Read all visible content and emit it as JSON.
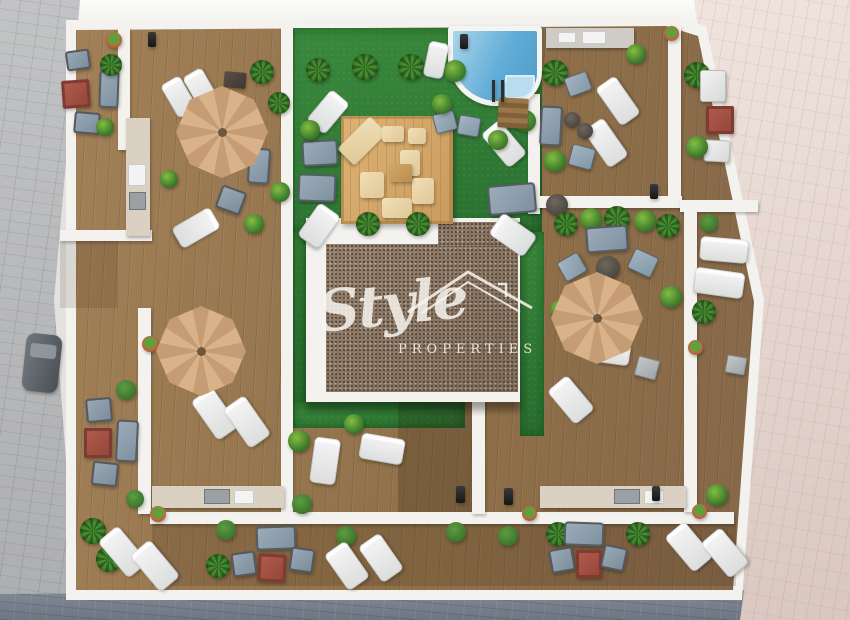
{
  "meta": {
    "image_type": "3d-aerial-architectural-render",
    "subject": "rooftop terrace site plan of apartment building with pool, garden courtyard, wooden deck terraces and outdoor furniture"
  },
  "watermark": {
    "brand_script": "Style",
    "brand_caps": "PROPERTIES",
    "logo_icon": "house-roof-outline"
  },
  "colors": {
    "wall": "#f3f2ee",
    "gravel-dot": "#55463a",
    "watermark": "rgba(248,245,238,0.85)",
    "lawn": "#2f7c33",
    "wood": "#9a7a52",
    "pool-water": "#5fa9d4",
    "umbrella": "#d3a87f",
    "pave-grey": "#b4b5b7",
    "pave-blue": "#79818c",
    "pave-pink": "#e0d2cb",
    "accent-red": "#a85043"
  },
  "areas": {
    "streets": [
      "left-grey-pavement",
      "bottom-blue-grey-pavement",
      "right-pink-pavement"
    ],
    "terraces": [
      "top-left-terrace",
      "left-terrace",
      "top-right-terrace",
      "right-terrace",
      "mid-right-terrace",
      "bottom-terrace"
    ],
    "courtyard": [
      "lawn",
      "swimming-pool",
      "sun-deck-platform",
      "central-building-white-roof",
      "central-building-gravel-roof"
    ]
  },
  "objects": [
    {
      "t": "umbrella",
      "x": 176,
      "y": 86,
      "w": 92,
      "h": 92,
      "r": 0
    },
    {
      "t": "umbrella",
      "x": 156,
      "y": 306,
      "w": 90,
      "h": 90,
      "r": 0
    },
    {
      "t": "umbrella",
      "x": 551,
      "y": 272,
      "w": 92,
      "h": 92,
      "r": 0
    },
    {
      "t": "car",
      "x": 24,
      "y": 334,
      "w": 36,
      "h": 58,
      "r": 6
    },
    {
      "t": "bollard",
      "x": 148,
      "y": 32,
      "w": 8,
      "h": 15,
      "r": 0
    },
    {
      "t": "bollard",
      "x": 460,
      "y": 34,
      "w": 8,
      "h": 15,
      "r": 0
    },
    {
      "t": "bollard",
      "x": 650,
      "y": 184,
      "w": 8,
      "h": 15,
      "r": 0
    },
    {
      "t": "bollard",
      "x": 456,
      "y": 486,
      "w": 9,
      "h": 17,
      "r": 0
    },
    {
      "t": "bollard",
      "x": 504,
      "y": 488,
      "w": 9,
      "h": 17,
      "r": 0
    },
    {
      "t": "bollard",
      "x": 652,
      "y": 486,
      "w": 8,
      "h": 15,
      "r": 0
    },
    {
      "t": "flowerpot",
      "x": 106,
      "y": 32,
      "w": 16,
      "h": 16,
      "r": 0
    },
    {
      "t": "flowerpot",
      "x": 664,
      "y": 26,
      "w": 15,
      "h": 15,
      "r": 0
    },
    {
      "t": "flowerpot",
      "x": 142,
      "y": 336,
      "w": 16,
      "h": 16,
      "r": 0
    },
    {
      "t": "flowerpot",
      "x": 150,
      "y": 506,
      "w": 16,
      "h": 16,
      "r": 0
    },
    {
      "t": "flowerpot",
      "x": 688,
      "y": 340,
      "w": 15,
      "h": 15,
      "r": 0
    },
    {
      "t": "flowerpot",
      "x": 692,
      "y": 504,
      "w": 15,
      "h": 15,
      "r": 0
    },
    {
      "t": "flowerpot",
      "x": 522,
      "y": 506,
      "w": 15,
      "h": 15,
      "r": 0
    },
    {
      "t": "chair",
      "x": 66,
      "y": 50,
      "w": 24,
      "h": 20,
      "r": -8
    },
    {
      "t": "sofa",
      "x": 99,
      "y": 70,
      "w": 20,
      "h": 38,
      "r": 2
    },
    {
      "t": "table-red",
      "x": 62,
      "y": 80,
      "w": 28,
      "h": 28,
      "r": -4
    },
    {
      "t": "chair",
      "x": 74,
      "y": 112,
      "w": 26,
      "h": 22,
      "r": 5
    },
    {
      "t": "plant",
      "x": 96,
      "y": 118,
      "w": 18,
      "h": 18,
      "r": 0
    },
    {
      "t": "palm",
      "x": 100,
      "y": 54,
      "w": 22,
      "h": 22,
      "r": 0
    },
    {
      "t": "lounger",
      "x": 168,
      "y": 78,
      "w": 22,
      "h": 38,
      "r": -30
    },
    {
      "t": "lounger",
      "x": 190,
      "y": 70,
      "w": 22,
      "h": 38,
      "r": -30
    },
    {
      "t": "table-dark",
      "x": 224,
      "y": 72,
      "w": 22,
      "h": 16,
      "r": 5
    },
    {
      "t": "sofa",
      "x": 248,
      "y": 148,
      "w": 22,
      "h": 36,
      "r": 4
    },
    {
      "t": "chair",
      "x": 218,
      "y": 188,
      "w": 26,
      "h": 24,
      "r": 20
    },
    {
      "t": "lounger",
      "x": 184,
      "y": 206,
      "w": 24,
      "h": 44,
      "r": 60
    },
    {
      "t": "palm",
      "x": 250,
      "y": 60,
      "w": 24,
      "h": 24,
      "r": 0
    },
    {
      "t": "palm",
      "x": 268,
      "y": 92,
      "w": 22,
      "h": 22,
      "r": 0
    },
    {
      "t": "plant",
      "x": 270,
      "y": 182,
      "w": 20,
      "h": 20,
      "r": 0
    },
    {
      "t": "plant",
      "x": 244,
      "y": 214,
      "w": 20,
      "h": 20,
      "r": 0
    },
    {
      "t": "plant",
      "x": 160,
      "y": 170,
      "w": 18,
      "h": 18,
      "r": 0
    },
    {
      "t": "cushion",
      "x": 350,
      "y": 118,
      "w": 24,
      "h": 46,
      "r": 45
    },
    {
      "t": "cushion",
      "x": 382,
      "y": 126,
      "w": 22,
      "h": 16,
      "r": 0
    },
    {
      "t": "cushion",
      "x": 400,
      "y": 150,
      "w": 20,
      "h": 26,
      "r": 0
    },
    {
      "t": "cushion",
      "x": 360,
      "y": 172,
      "w": 24,
      "h": 26,
      "r": 0
    },
    {
      "t": "cushion",
      "x": 382,
      "y": 198,
      "w": 30,
      "h": 20,
      "r": 0
    },
    {
      "t": "cushion",
      "x": 412,
      "y": 178,
      "w": 22,
      "h": 26,
      "r": 0
    },
    {
      "t": "cushion",
      "x": 408,
      "y": 128,
      "w": 18,
      "h": 16,
      "r": 0
    },
    {
      "t": "table-wood",
      "x": 390,
      "y": 164,
      "w": 22,
      "h": 18,
      "r": 0
    },
    {
      "t": "lounger",
      "x": 316,
      "y": 92,
      "w": 24,
      "h": 40,
      "r": 40
    },
    {
      "t": "sofa",
      "x": 302,
      "y": 140,
      "w": 36,
      "h": 26,
      "r": -3
    },
    {
      "t": "sofa",
      "x": 298,
      "y": 174,
      "w": 38,
      "h": 28,
      "r": 2
    },
    {
      "t": "lounger",
      "x": 306,
      "y": 206,
      "w": 26,
      "h": 40,
      "r": 35
    },
    {
      "t": "lounger",
      "x": 492,
      "y": 122,
      "w": 24,
      "h": 44,
      "r": -40
    },
    {
      "t": "sofa",
      "x": 488,
      "y": 184,
      "w": 48,
      "h": 30,
      "r": -5
    },
    {
      "t": "table-round",
      "x": 546,
      "y": 194,
      "w": 22,
      "h": 22,
      "r": 0
    },
    {
      "t": "lounger",
      "x": 500,
      "y": 214,
      "w": 26,
      "h": 42,
      "r": -55
    },
    {
      "t": "palm",
      "x": 306,
      "y": 58,
      "w": 24,
      "h": 24,
      "r": 0
    },
    {
      "t": "palm",
      "x": 352,
      "y": 54,
      "w": 26,
      "h": 26,
      "r": 0
    },
    {
      "t": "palm",
      "x": 398,
      "y": 54,
      "w": 26,
      "h": 26,
      "r": 0
    },
    {
      "t": "plant",
      "x": 444,
      "y": 60,
      "w": 22,
      "h": 22,
      "r": 0
    },
    {
      "t": "palm",
      "x": 356,
      "y": 212,
      "w": 24,
      "h": 24,
      "r": 0
    },
    {
      "t": "palm",
      "x": 406,
      "y": 212,
      "w": 24,
      "h": 24,
      "r": 0
    },
    {
      "t": "plant",
      "x": 300,
      "y": 120,
      "w": 20,
      "h": 20,
      "r": 0
    },
    {
      "t": "plant",
      "x": 514,
      "y": 110,
      "w": 22,
      "h": 22,
      "r": 0
    },
    {
      "t": "plant",
      "x": 488,
      "y": 130,
      "w": 20,
      "h": 20,
      "r": 0
    },
    {
      "t": "lounger",
      "x": 426,
      "y": 42,
      "w": 20,
      "h": 36,
      "r": 12
    },
    {
      "t": "chair-blue",
      "x": 434,
      "y": 112,
      "w": 22,
      "h": 20,
      "r": -15
    },
    {
      "t": "chair-blue",
      "x": 458,
      "y": 116,
      "w": 22,
      "h": 20,
      "r": 10
    },
    {
      "t": "plant",
      "x": 432,
      "y": 94,
      "w": 20,
      "h": 20,
      "r": 0
    },
    {
      "t": "steps",
      "x": 498,
      "y": 98,
      "w": 30,
      "h": 30,
      "r": 3
    },
    {
      "t": "ladder",
      "x": 492,
      "y": 80,
      "w": 12,
      "h": 22,
      "r": 0
    },
    {
      "t": "palm",
      "x": 542,
      "y": 60,
      "w": 26,
      "h": 26,
      "r": 0
    },
    {
      "t": "chair-blue",
      "x": 566,
      "y": 74,
      "w": 24,
      "h": 20,
      "r": -20
    },
    {
      "t": "lounger",
      "x": 606,
      "y": 78,
      "w": 24,
      "h": 46,
      "r": -35
    },
    {
      "t": "lounger",
      "x": 594,
      "y": 120,
      "w": 24,
      "h": 46,
      "r": -35
    },
    {
      "t": "table-round",
      "x": 564,
      "y": 112,
      "w": 16,
      "h": 16,
      "r": 0
    },
    {
      "t": "table-round",
      "x": 577,
      "y": 123,
      "w": 16,
      "h": 16,
      "r": 0
    },
    {
      "t": "sofa",
      "x": 540,
      "y": 106,
      "w": 22,
      "h": 40,
      "r": 3
    },
    {
      "t": "chair-blue",
      "x": 570,
      "y": 146,
      "w": 24,
      "h": 22,
      "r": 15
    },
    {
      "t": "plant",
      "x": 544,
      "y": 150,
      "w": 22,
      "h": 22,
      "r": 0
    },
    {
      "t": "plant",
      "x": 626,
      "y": 44,
      "w": 20,
      "h": 20,
      "r": 0
    },
    {
      "t": "palm",
      "x": 684,
      "y": 62,
      "w": 26,
      "h": 26,
      "r": 0
    },
    {
      "t": "chair-white",
      "x": 700,
      "y": 70,
      "w": 26,
      "h": 32,
      "r": 0
    },
    {
      "t": "table-red",
      "x": 706,
      "y": 106,
      "w": 28,
      "h": 28,
      "r": 0
    },
    {
      "t": "chair-white",
      "x": 704,
      "y": 140,
      "w": 26,
      "h": 22,
      "r": 3
    },
    {
      "t": "plant",
      "x": 686,
      "y": 136,
      "w": 22,
      "h": 22,
      "r": 0
    },
    {
      "t": "topiary",
      "x": 700,
      "y": 214,
      "w": 18,
      "h": 18,
      "r": 0
    },
    {
      "t": "lounger",
      "x": 700,
      "y": 238,
      "w": 48,
      "h": 24,
      "r": 5
    },
    {
      "t": "lounger",
      "x": 694,
      "y": 270,
      "w": 50,
      "h": 26,
      "r": 8
    },
    {
      "t": "palm",
      "x": 692,
      "y": 300,
      "w": 24,
      "h": 24,
      "r": 0
    },
    {
      "t": "cube",
      "x": 726,
      "y": 356,
      "w": 20,
      "h": 18,
      "r": 10
    },
    {
      "t": "palm",
      "x": 554,
      "y": 212,
      "w": 24,
      "h": 24,
      "r": 0
    },
    {
      "t": "plant",
      "x": 580,
      "y": 208,
      "w": 22,
      "h": 22,
      "r": 0
    },
    {
      "t": "palm",
      "x": 604,
      "y": 206,
      "w": 26,
      "h": 26,
      "r": 0
    },
    {
      "t": "plant",
      "x": 634,
      "y": 210,
      "w": 22,
      "h": 22,
      "r": 0
    },
    {
      "t": "palm",
      "x": 656,
      "y": 214,
      "w": 24,
      "h": 24,
      "r": 0
    },
    {
      "t": "sofa",
      "x": 586,
      "y": 226,
      "w": 42,
      "h": 26,
      "r": -4
    },
    {
      "t": "table-round",
      "x": 596,
      "y": 256,
      "w": 24,
      "h": 24,
      "r": 0
    },
    {
      "t": "chair-blue",
      "x": 560,
      "y": 256,
      "w": 24,
      "h": 22,
      "r": -30
    },
    {
      "t": "chair-blue",
      "x": 630,
      "y": 252,
      "w": 26,
      "h": 22,
      "r": 25
    },
    {
      "t": "lounger",
      "x": 594,
      "y": 342,
      "w": 36,
      "h": 22,
      "r": 8
    },
    {
      "t": "cube",
      "x": 636,
      "y": 358,
      "w": 22,
      "h": 20,
      "r": 15
    },
    {
      "t": "lounger",
      "x": 558,
      "y": 378,
      "w": 26,
      "h": 44,
      "r": -40
    },
    {
      "t": "plant",
      "x": 550,
      "y": 300,
      "w": 20,
      "h": 20,
      "r": 0
    },
    {
      "t": "plant",
      "x": 660,
      "y": 286,
      "w": 22,
      "h": 22,
      "r": 0
    },
    {
      "t": "lounger",
      "x": 202,
      "y": 390,
      "w": 26,
      "h": 48,
      "r": -35
    },
    {
      "t": "lounger",
      "x": 234,
      "y": 398,
      "w": 26,
      "h": 48,
      "r": -35
    },
    {
      "t": "lounger",
      "x": 312,
      "y": 438,
      "w": 26,
      "h": 46,
      "r": 8
    },
    {
      "t": "lounger",
      "x": 360,
      "y": 436,
      "w": 44,
      "h": 26,
      "r": 10
    },
    {
      "t": "plant",
      "x": 288,
      "y": 430,
      "w": 22,
      "h": 22,
      "r": 0
    },
    {
      "t": "plant",
      "x": 344,
      "y": 414,
      "w": 20,
      "h": 20,
      "r": 0
    },
    {
      "t": "topiary",
      "x": 292,
      "y": 494,
      "w": 20,
      "h": 20,
      "r": 0
    },
    {
      "t": "topiary",
      "x": 116,
      "y": 380,
      "w": 20,
      "h": 20,
      "r": 0
    },
    {
      "t": "chair",
      "x": 86,
      "y": 398,
      "w": 26,
      "h": 24,
      "r": -5
    },
    {
      "t": "table-red",
      "x": 84,
      "y": 428,
      "w": 28,
      "h": 30,
      "r": 0
    },
    {
      "t": "sofa",
      "x": 116,
      "y": 420,
      "w": 22,
      "h": 42,
      "r": 3
    },
    {
      "t": "chair",
      "x": 92,
      "y": 462,
      "w": 26,
      "h": 24,
      "r": 6
    },
    {
      "t": "topiary",
      "x": 126,
      "y": 490,
      "w": 18,
      "h": 18,
      "r": 0
    },
    {
      "t": "palm",
      "x": 80,
      "y": 518,
      "w": 26,
      "h": 26,
      "r": 0
    },
    {
      "t": "palm",
      "x": 96,
      "y": 546,
      "w": 26,
      "h": 26,
      "r": 0
    },
    {
      "t": "lounger",
      "x": 110,
      "y": 528,
      "w": 26,
      "h": 48,
      "r": -40
    },
    {
      "t": "lounger",
      "x": 142,
      "y": 542,
      "w": 26,
      "h": 48,
      "r": -40
    },
    {
      "t": "palm",
      "x": 206,
      "y": 554,
      "w": 24,
      "h": 24,
      "r": 0
    },
    {
      "t": "topiary",
      "x": 216,
      "y": 520,
      "w": 20,
      "h": 20,
      "r": 0
    },
    {
      "t": "sofa",
      "x": 256,
      "y": 526,
      "w": 40,
      "h": 24,
      "r": -2
    },
    {
      "t": "chair",
      "x": 232,
      "y": 552,
      "w": 24,
      "h": 24,
      "r": -8
    },
    {
      "t": "table-red",
      "x": 258,
      "y": 554,
      "w": 28,
      "h": 28,
      "r": 3
    },
    {
      "t": "chair",
      "x": 290,
      "y": 548,
      "w": 24,
      "h": 24,
      "r": 8
    },
    {
      "t": "topiary",
      "x": 336,
      "y": 526,
      "w": 20,
      "h": 20,
      "r": 0
    },
    {
      "t": "lounger",
      "x": 334,
      "y": 544,
      "w": 26,
      "h": 44,
      "r": -35
    },
    {
      "t": "lounger",
      "x": 368,
      "y": 536,
      "w": 26,
      "h": 44,
      "r": -35
    },
    {
      "t": "topiary",
      "x": 446,
      "y": 522,
      "w": 20,
      "h": 20,
      "r": 0
    },
    {
      "t": "topiary",
      "x": 498,
      "y": 526,
      "w": 20,
      "h": 20,
      "r": 0
    },
    {
      "t": "palm",
      "x": 546,
      "y": 522,
      "w": 24,
      "h": 24,
      "r": 0
    },
    {
      "t": "sofa",
      "x": 564,
      "y": 522,
      "w": 40,
      "h": 24,
      "r": 2
    },
    {
      "t": "chair",
      "x": 550,
      "y": 548,
      "w": 24,
      "h": 24,
      "r": -10
    },
    {
      "t": "table-red",
      "x": 576,
      "y": 550,
      "w": 26,
      "h": 28,
      "r": 0
    },
    {
      "t": "chair",
      "x": 602,
      "y": 546,
      "w": 24,
      "h": 24,
      "r": 12
    },
    {
      "t": "palm",
      "x": 626,
      "y": 522,
      "w": 24,
      "h": 24,
      "r": 0
    },
    {
      "t": "plant",
      "x": 706,
      "y": 484,
      "w": 22,
      "h": 22,
      "r": 0
    },
    {
      "t": "lounger",
      "x": 676,
      "y": 524,
      "w": 26,
      "h": 46,
      "r": -40
    },
    {
      "t": "lounger",
      "x": 712,
      "y": 530,
      "w": 26,
      "h": 46,
      "r": -40
    }
  ]
}
